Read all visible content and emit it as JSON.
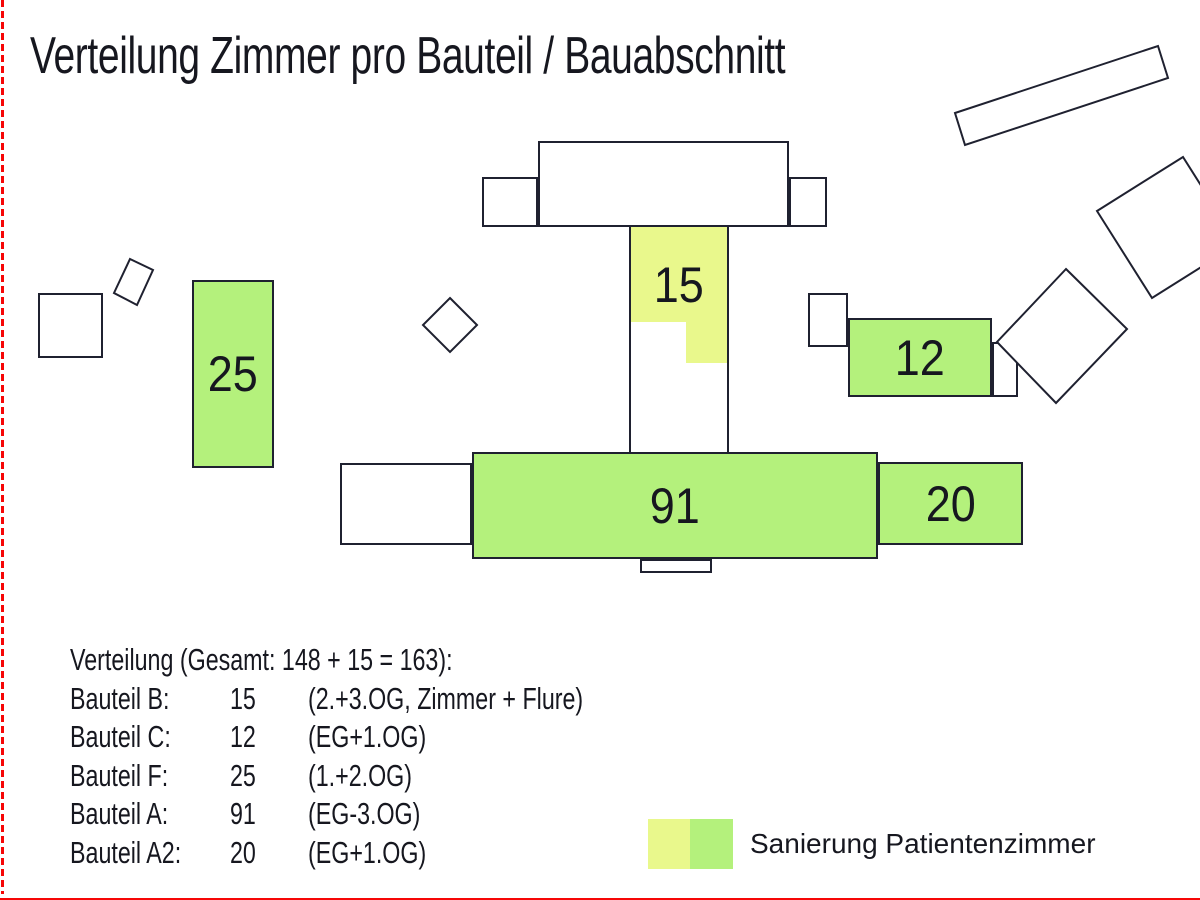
{
  "title": "Verteilung Zimmer pro Bauteil / Bauabschnitt",
  "plan": {
    "bauteil_b_label": "15",
    "bauteil_c_label": "12",
    "bauteil_f_label": "25",
    "bauteil_a_label": "91",
    "bauteil_a2_label": "20"
  },
  "summary": {
    "heading": "Verteilung (Gesamt: 148 + 15 = 163):",
    "rows": [
      {
        "label": "Bauteil B:",
        "value": "15",
        "note": "(2.+3.OG, Zimmer + Flure)"
      },
      {
        "label": "Bauteil C:",
        "value": "12",
        "note": "(EG+1.OG)"
      },
      {
        "label": "Bauteil F:",
        "value": "25",
        "note": "(1.+2.OG)"
      },
      {
        "label": "Bauteil A:",
        "value": "91",
        "note": "(EG-3.OG)"
      },
      {
        "label": "Bauteil A2:",
        "value": "20",
        "note": "(EG+1.OG)"
      }
    ]
  },
  "legend": {
    "label": "Sanierung Patientenzimmer"
  },
  "colors": {
    "sanierung_green": "#b4f17c",
    "sanierung_yellow": "#e9f88c",
    "outline": "#1f2130",
    "boundary_red": "#f60606"
  }
}
